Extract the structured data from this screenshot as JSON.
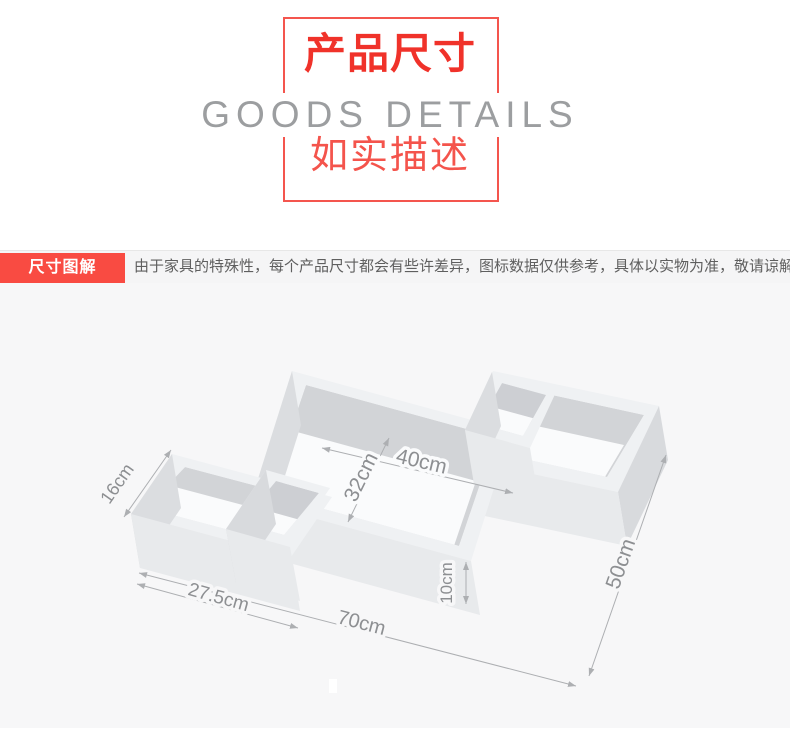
{
  "header": {
    "title_cn": "产品尺寸",
    "title_en": "GOODS DETAILS",
    "subtitle_cn": "如实描述"
  },
  "section_bar": {
    "label": "尺寸图解",
    "description": "由于家具的特殊性，每个产品尺寸都会有些许差异，图标数据仅供参考，具体以实物为准，敬请谅解。"
  },
  "diagram": {
    "product": "wall-shelf",
    "labels": {
      "depth": "16cm",
      "left_width": "27.5cm",
      "total_width": "70cm",
      "inner_width": "40cm",
      "inner_height": "32cm",
      "panel_height": "10cm",
      "total_height": "50cm"
    }
  },
  "colors": {
    "accent_red": "#f94b42",
    "title_red": "#f0322a",
    "frame_border_red": "#f4554e",
    "subtitle_red": "#f4544c",
    "muted_gray_text": "#9c9ea0",
    "bar_text": "#5f5f5f",
    "dim_text": "#8d8f92",
    "diagram_bg": "#f7f7f8"
  }
}
